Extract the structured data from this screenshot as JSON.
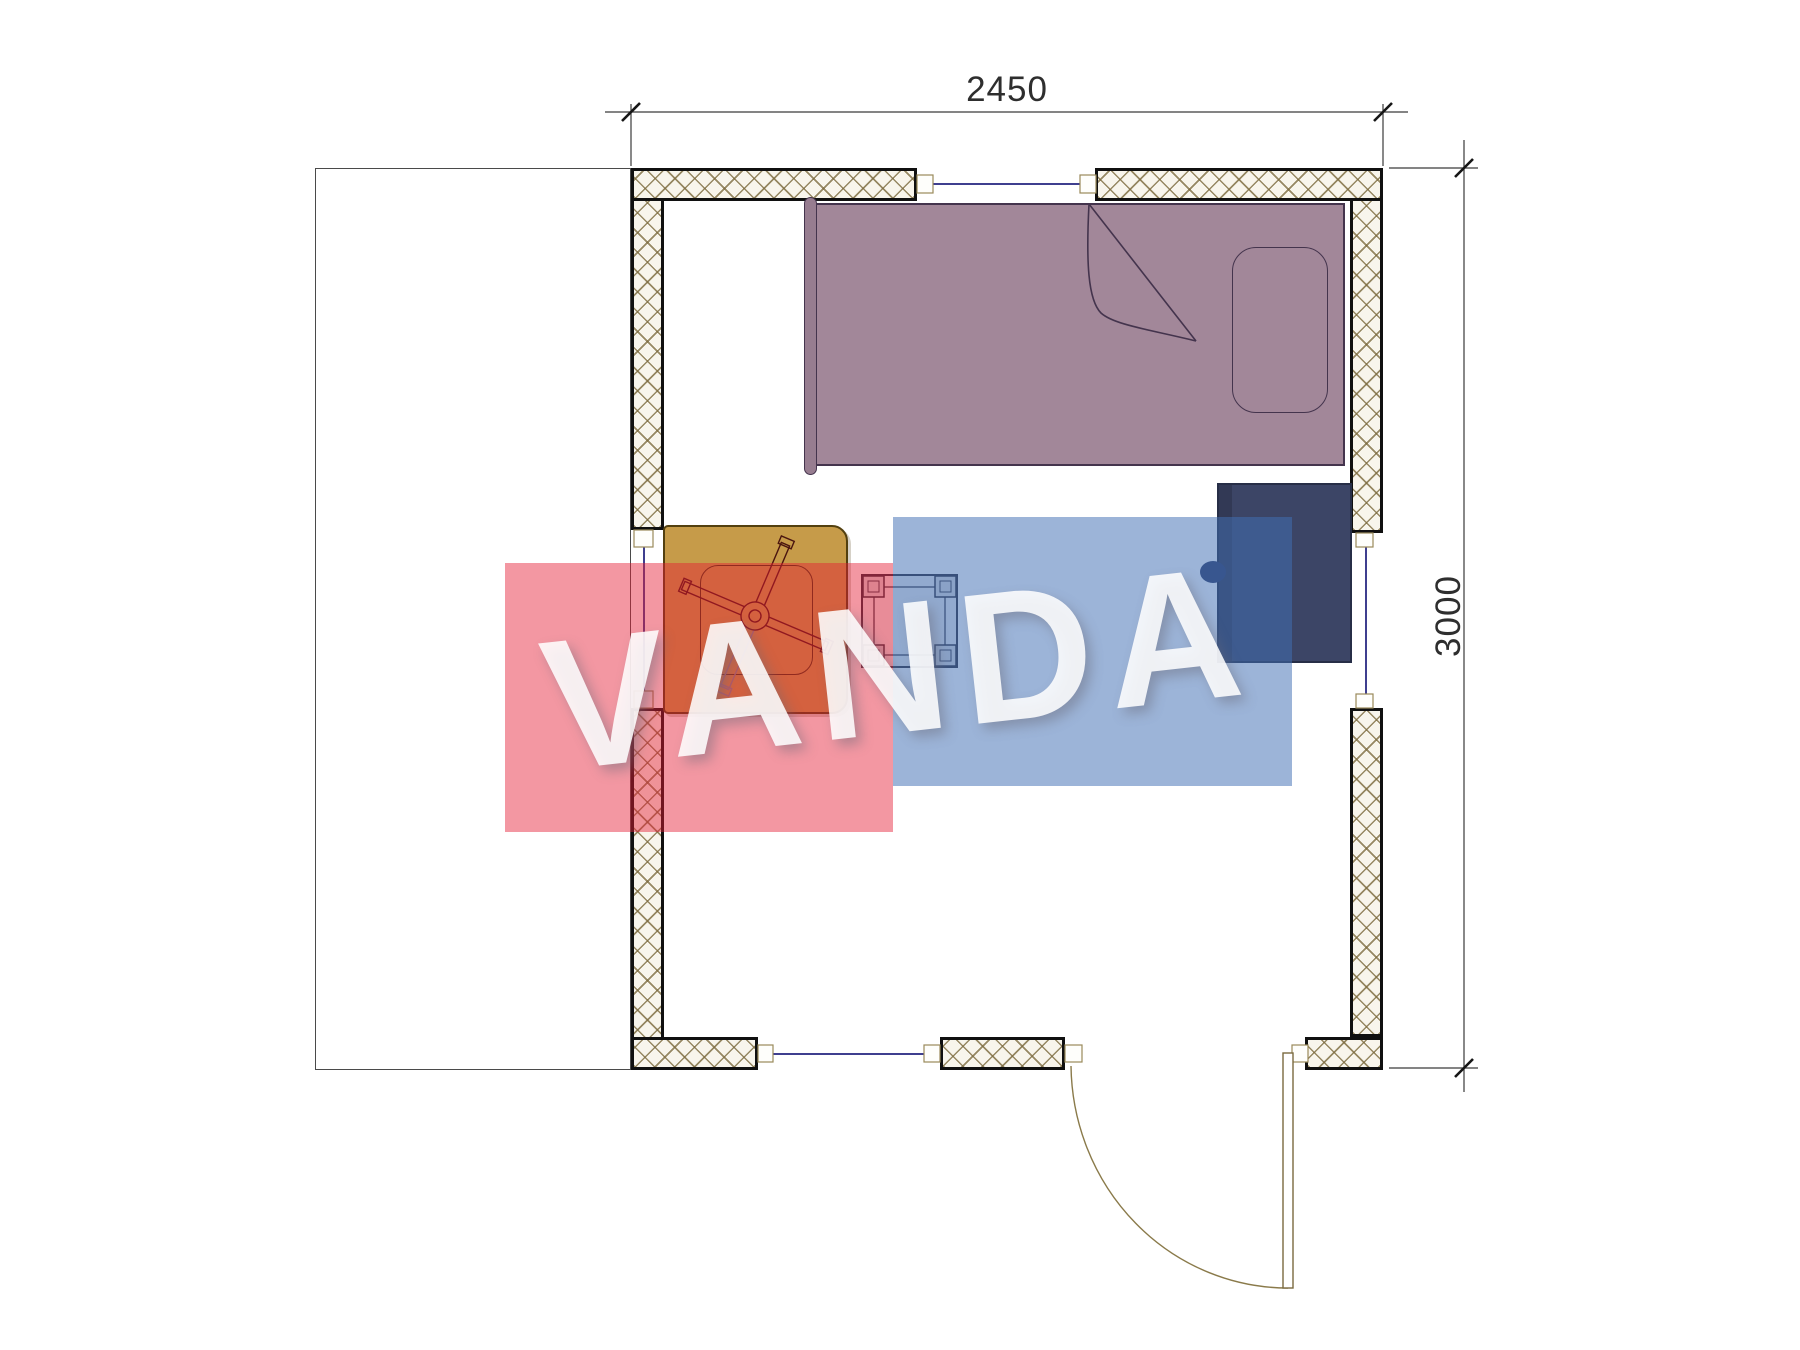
{
  "dimensions": {
    "width_label": "2450",
    "height_label": "3000"
  },
  "watermark": {
    "text": "VANDA",
    "red": "#E41C35",
    "blue": "#416FB4"
  },
  "colors": {
    "bed": "#A28799",
    "cabinet": "#3C4566",
    "table": "#C69B49",
    "wall_hatch": "#7D6C40",
    "window_line": "#3F3F8F",
    "dimension_line": "#3a3a3a"
  }
}
